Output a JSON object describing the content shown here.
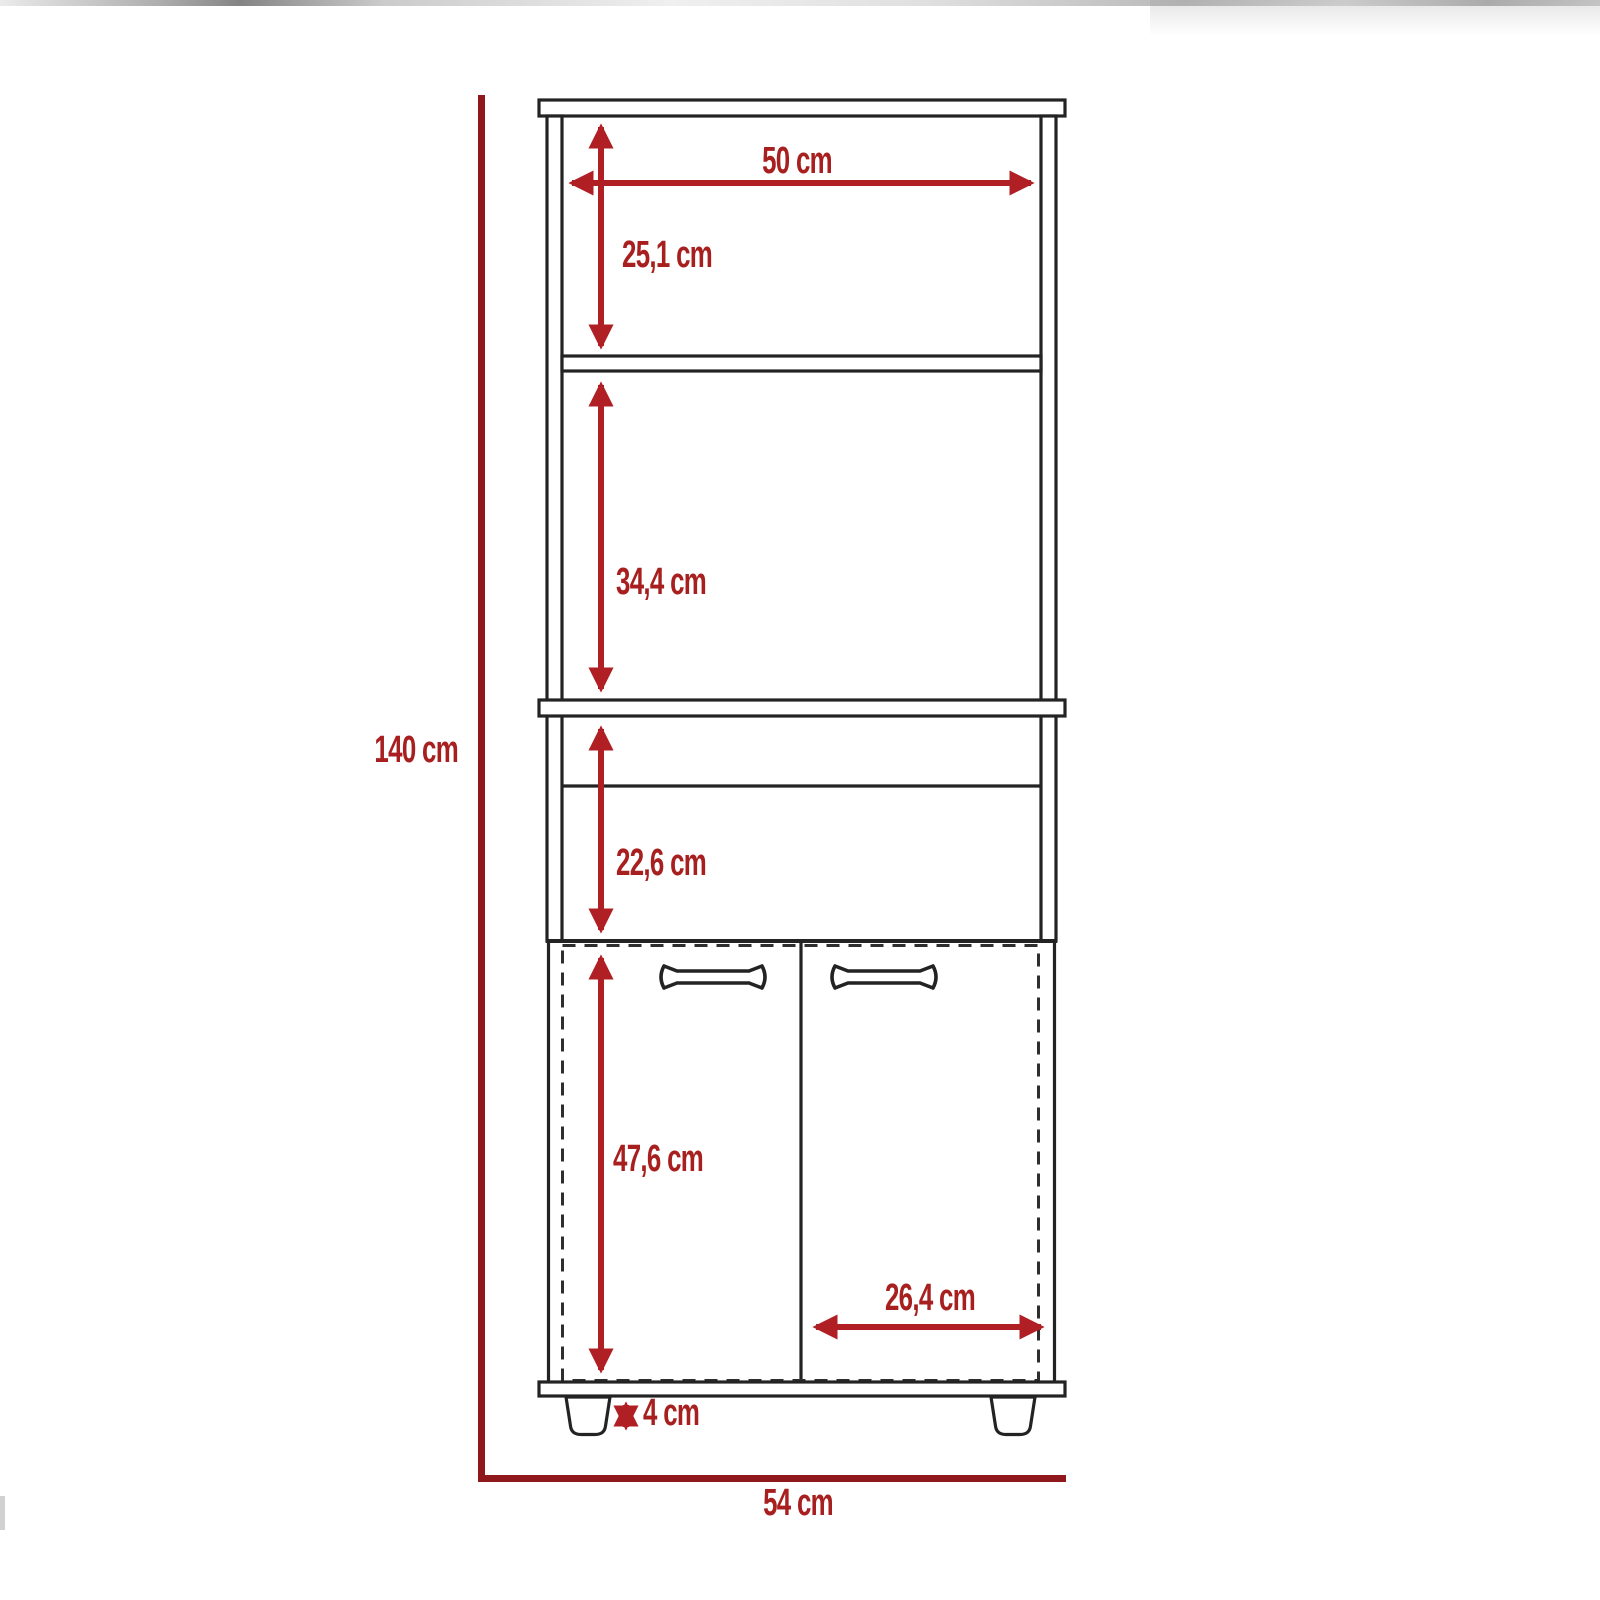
{
  "diagram": {
    "unit": "cm",
    "colors": {
      "arrow_red": "#B01F24",
      "dark_red": "#8E181B",
      "label_red": "#A7201F",
      "line_black": "#232323",
      "dash_gray": "#2E2E2E",
      "background": "#FFFFFF"
    },
    "dimensions": {
      "overall_height": {
        "value": 140,
        "unit": "cm",
        "label": "140 cm"
      },
      "overall_width": {
        "value": 54,
        "unit": "cm",
        "label": "54 cm"
      },
      "interior_width": {
        "value": 50,
        "unit": "cm",
        "label": "50 cm"
      },
      "upper_compartment_height": {
        "value": 25.1,
        "unit": "cm",
        "label": "25,1 cm"
      },
      "middle_compartment_height": {
        "value": 34.4,
        "unit": "cm",
        "label": "34,4 cm"
      },
      "lower_compartment_height": {
        "value": 22.6,
        "unit": "cm",
        "label": "22,6 cm"
      },
      "door_height": {
        "value": 47.6,
        "unit": "cm",
        "label": "47,6 cm"
      },
      "door_width": {
        "value": 26.4,
        "unit": "cm",
        "label": "26,4 cm"
      },
      "leg_height": {
        "value": 4,
        "unit": "cm",
        "label": "4 cm"
      }
    }
  }
}
